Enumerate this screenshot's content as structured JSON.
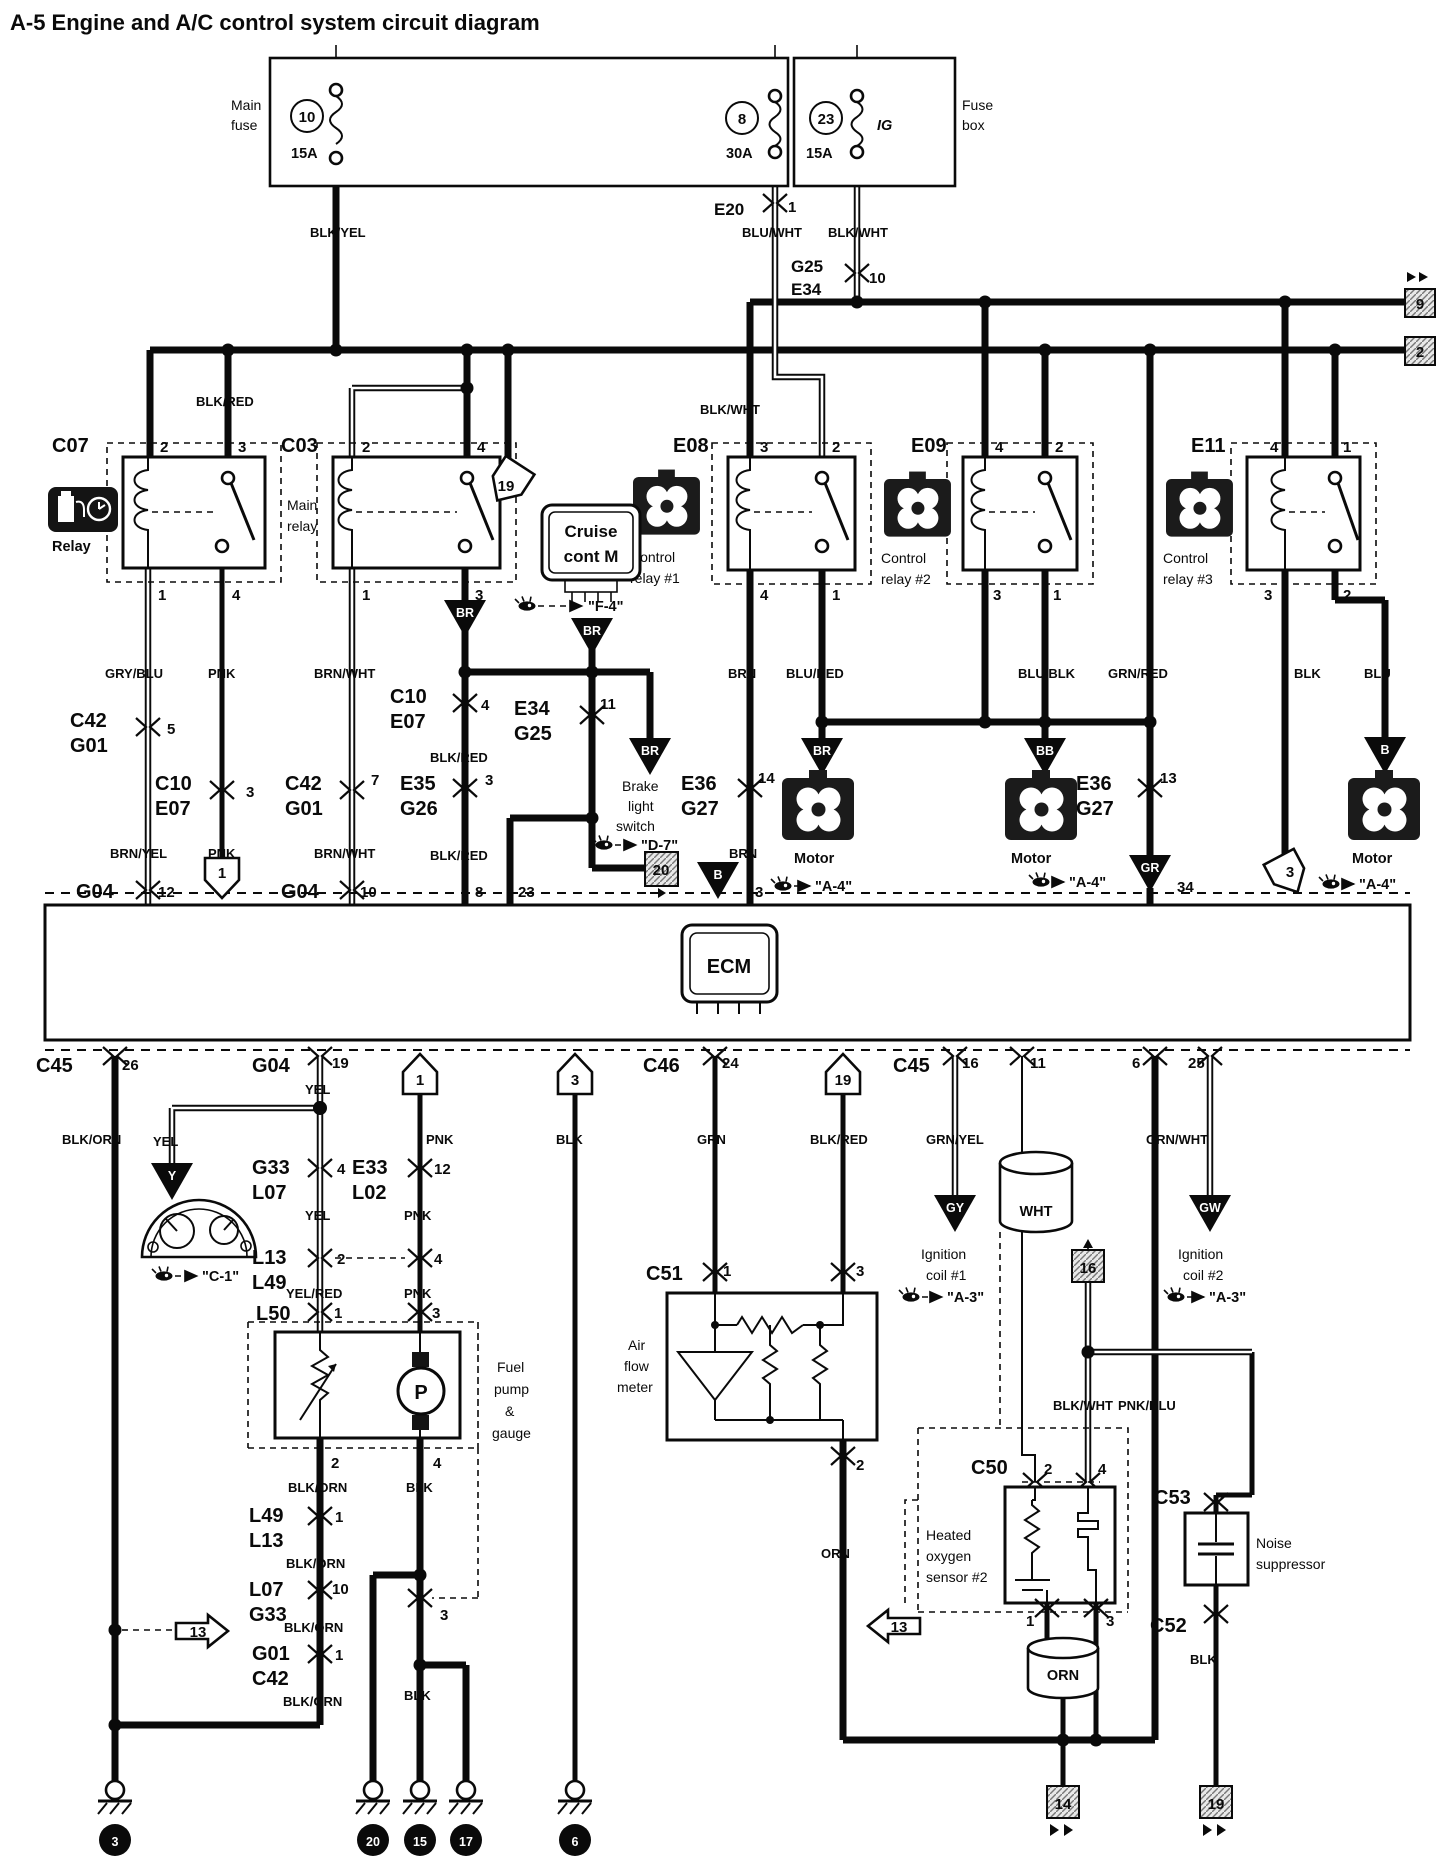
{
  "title": "A-5 Engine and A/C control system circuit diagram",
  "fusebox": {
    "label": [
      "Fuse",
      "box"
    ],
    "main_fuse": [
      "Main",
      "fuse"
    ],
    "ig": "IG",
    "f10": {
      "no": "10",
      "amp": "15A"
    },
    "f8": {
      "no": "8",
      "amp": "30A"
    },
    "f23": {
      "no": "23",
      "amp": "15A"
    }
  },
  "conn": {
    "c07": "C07",
    "c03": "C03",
    "e08": "E08",
    "e09": "E09",
    "e11": "E11",
    "e20": "E20",
    "g25": "G25",
    "e34": "E34",
    "c42": "C42",
    "g01": "G01",
    "c10": "C10",
    "e07": "E07",
    "e35": "E35",
    "g26": "G26",
    "e36": "E36",
    "g27": "G27",
    "g04": "G04",
    "c45": "C45",
    "c46": "C46",
    "c51": "C51",
    "c50": "C50",
    "c53": "C53",
    "c52": "C52",
    "l50": "L50",
    "l49": "L49",
    "l13": "L13",
    "l07": "L07",
    "g33": "G33",
    "e33": "E33",
    "l02": "L02"
  },
  "pins": {
    "n1": "1",
    "n2": "2",
    "n3": "3",
    "n4": "4",
    "n5": "5",
    "n6": "6",
    "n7": "7",
    "n8": "8",
    "n10": "10",
    "n11": "11",
    "n12": "12",
    "n13": "13",
    "n14": "14",
    "n16": "16",
    "n19": "19",
    "n23": "23",
    "n24": "24",
    "n25": "25",
    "n26": "26",
    "n34": "34"
  },
  "colors": {
    "blk_yel": "BLK/YEL",
    "blu_wht": "BLU/WHT",
    "blk_wht": "BLK/WHT",
    "blk_red": "BLK/RED",
    "gry_blu": "GRY/BLU",
    "pnk": "PNK",
    "brn_wht": "BRN/WHT",
    "brn_yel": "BRN/YEL",
    "brn": "BRN",
    "blu_red": "BLU/RED",
    "blu_blk": "BLU/BLK",
    "grn_red": "GRN/RED",
    "blk": "BLK",
    "blu": "BLU",
    "blk_orn": "BLK/ORN",
    "yel": "YEL",
    "yel_red": "YEL/RED",
    "grn": "GRN",
    "grn_yel": "GRN/YEL",
    "grn_wht": "GRN/WHT",
    "orn": "ORN",
    "wht": "WHT",
    "pnk_blu": "PNK/BLU"
  },
  "comp": {
    "relay": "Relay",
    "main_relay": [
      "Main",
      "relay"
    ],
    "cr1": [
      "Control",
      "relay #1"
    ],
    "cr2": [
      "Control",
      "relay #2"
    ],
    "cr3": [
      "Control",
      "relay #3"
    ],
    "cruise": [
      "Cruise",
      "cont M"
    ],
    "brake": [
      "Brake",
      "light",
      "switch"
    ],
    "motor": "Motor",
    "ecm": "ECM",
    "fuel": [
      "Fuel",
      "pump",
      "&",
      "gauge"
    ],
    "afm": [
      "Air",
      "flow",
      "meter"
    ],
    "o2": [
      "Heated",
      "oxygen",
      "sensor #2"
    ],
    "noise": [
      "Noise",
      "suppressor"
    ],
    "ign1": [
      "Ignition",
      "coil #1"
    ],
    "ign2": [
      "Ignition",
      "coil #2"
    ]
  },
  "refs": {
    "f4": "\"F-4\"",
    "d7": "\"D-7\"",
    "a4": "\"A-4\"",
    "c1": "\"C-1\"",
    "a3": "\"A-3\""
  },
  "codes": {
    "br": "BR",
    "bb": "BB",
    "b": "B",
    "gr": "GR",
    "y": "Y",
    "gy": "GY",
    "gw": "GW"
  },
  "markers": {
    "m9": "9",
    "m2": "2",
    "m19": "19",
    "m1": "1",
    "m3": "3",
    "m13": "13",
    "m20": "20",
    "m16": "16"
  },
  "grounds": {
    "g3": "3",
    "g20": "20",
    "g15": "15",
    "g17": "17",
    "g6": "6",
    "g14": "14",
    "g19": "19"
  }
}
